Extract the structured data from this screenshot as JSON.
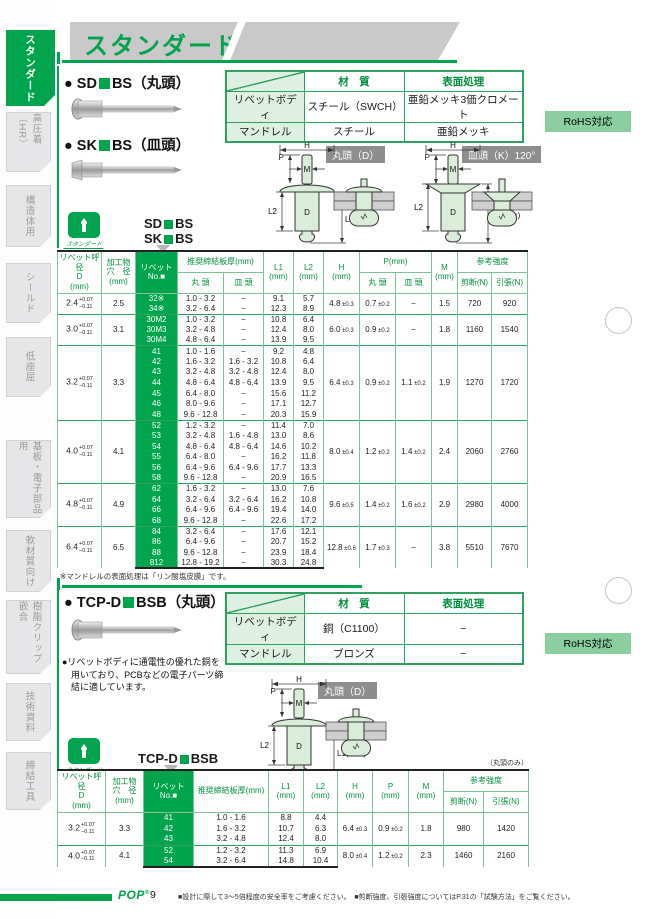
{
  "header": {
    "title": "スタンダード"
  },
  "sidebar": {
    "tabs": [
      {
        "label": "スタンダード",
        "active": true
      },
      {
        "label": "高圧着（HR）",
        "active": false
      },
      {
        "label": "構造体用",
        "active": false
      },
      {
        "label": "シールド",
        "active": false
      },
      {
        "label": "低座屈",
        "active": false
      },
      {
        "label": "基板・電子部品用",
        "active": false
      },
      {
        "label": "軟材質向け",
        "active": false
      },
      {
        "label": "樹脂クリップ嵌合",
        "active": false
      },
      {
        "label": "技術資料",
        "active": false
      },
      {
        "label": "締結工具",
        "active": false
      }
    ]
  },
  "dims": {
    "h": "H",
    "p": "P",
    "m": "M",
    "l2": "L2",
    "d": "D",
    "l1": "L1(max)"
  },
  "stamp_text": "スタンダード",
  "rohs": "RoHS対応",
  "section1": {
    "title1_pre": "● SD",
    "title1_post": "BS（丸頭）",
    "title2_pre": "● SK",
    "title2_post": "BS（皿頭）",
    "material": {
      "col_material": "材　質",
      "col_surface": "表面処理",
      "rows": [
        {
          "part": "リベットボディ",
          "material": "スチール（SWCH）",
          "surface": "亜鉛メッキ3価クロメート"
        },
        {
          "part": "マンドレル",
          "material": "スチール",
          "surface": "亜鉛メッキ"
        }
      ]
    },
    "label_round": "丸頭（D）",
    "label_flat": "皿頭（K）120°",
    "callout1_pre": "SD",
    "callout1_post": "BS",
    "callout2_pre": "SK",
    "callout2_post": "BS",
    "note": "※マンドレルの表面処理は「リン酸塩皮膜」です。"
  },
  "table1": {
    "head": {
      "dia": [
        "リベット呼径",
        "D",
        "(mm)"
      ],
      "hole": [
        "加工物",
        "穴　径",
        "(mm)"
      ],
      "rivet": [
        "リベット",
        "No.■"
      ],
      "plate": "推奨締結板厚(mm)",
      "round": "丸 頭",
      "flat": "皿 頭",
      "l1": [
        "L1",
        "(mm)"
      ],
      "l2": [
        "L2",
        "(mm)"
      ],
      "h": [
        "H",
        "(mm)"
      ],
      "p": "P(mm)",
      "p_round": "丸 頭",
      "p_flat": "皿 頭",
      "m": [
        "M",
        "(mm)"
      ],
      "strength": "参考強度",
      "shear": "剪断(N)",
      "tensile": "引張(N)"
    },
    "groups": [
      {
        "dia": "2.4",
        "tp": "+0.07",
        "tm": "−0.11",
        "hole": "2.5",
        "h": "4.8",
        "h_tol": "±0.3",
        "p_round": "0.7",
        "p_round_tol": "±0.2",
        "p_flat": "−",
        "p_flat_tol": "",
        "m": "1.5",
        "shear": "720",
        "tensile": "920",
        "rows": [
          [
            "32※",
            "1.0 - 3.2",
            "−",
            "9.1",
            "5.7"
          ],
          [
            "34※",
            "3.2 - 6.4",
            "−",
            "12.3",
            "8.9"
          ]
        ]
      },
      {
        "dia": "3.0",
        "tp": "+0.07",
        "tm": "−0.11",
        "hole": "3.1",
        "h": "6.0",
        "h_tol": "±0.3",
        "p_round": "0.9",
        "p_round_tol": "±0.2",
        "p_flat": "−",
        "p_flat_tol": "",
        "m": "1.8",
        "shear": "1160",
        "tensile": "1540",
        "rows": [
          [
            "30M2",
            "1.0 - 3.2",
            "−",
            "10.8",
            "6.4"
          ],
          [
            "30M3",
            "3.2 - 4.8",
            "−",
            "12.4",
            "8.0"
          ],
          [
            "30M4",
            "4.8 - 6.4",
            "−",
            "13.9",
            "9.5"
          ]
        ]
      },
      {
        "dia": "3.2",
        "tp": "+0.07",
        "tm": "−0.11",
        "hole": "3.3",
        "h": "6.4",
        "h_tol": "±0.3",
        "p_round": "0.9",
        "p_round_tol": "±0.2",
        "p_flat": "1.1",
        "p_flat_tol": "±0.2",
        "m": "1.9",
        "shear": "1270",
        "tensile": "1720",
        "rows": [
          [
            "41",
            "1.0 - 1.6",
            "−",
            "9.2",
            "4.8"
          ],
          [
            "42",
            "1.6 - 3.2",
            "1.6 - 3.2",
            "10.8",
            "6.4"
          ],
          [
            "43",
            "3.2 - 4.8",
            "3.2 - 4.8",
            "12.4",
            "8.0"
          ],
          [
            "44",
            "4.8 - 6.4",
            "4.8 - 6.4",
            "13.9",
            "9.5"
          ],
          [
            "45",
            "6.4 - 8.0",
            "−",
            "15.6",
            "11.2"
          ],
          [
            "46",
            "8.0 - 9.6",
            "−",
            "17.1",
            "12.7"
          ],
          [
            "48",
            "9.6 - 12.8",
            "−",
            "20.3",
            "15.9"
          ]
        ]
      },
      {
        "dia": "4.0",
        "tp": "+0.07",
        "tm": "−0.11",
        "hole": "4.1",
        "h": "8.0",
        "h_tol": "±0.4",
        "p_round": "1.2",
        "p_round_tol": "±0.2",
        "p_flat": "1.4",
        "p_flat_tol": "±0.2",
        "m": "2.4",
        "shear": "2060",
        "tensile": "2760",
        "rows": [
          [
            "52",
            "1.2 - 3.2",
            "−",
            "11.4",
            "7.0"
          ],
          [
            "53",
            "3.2 - 4.8",
            "1.6 - 4.8",
            "13.0",
            "8.6"
          ],
          [
            "54",
            "4.8 - 6.4",
            "4.8 - 6.4",
            "14.6",
            "10.2"
          ],
          [
            "55",
            "6.4 - 8.0",
            "−",
            "16.2",
            "11.8"
          ],
          [
            "56",
            "6.4 - 9.6",
            "6.4 - 9.6",
            "17.7",
            "13.3"
          ],
          [
            "58",
            "9.6 - 12.8",
            "−",
            "20.9",
            "16.5"
          ]
        ]
      },
      {
        "dia": "4.8",
        "tp": "+0.07",
        "tm": "−0.11",
        "hole": "4.9",
        "h": "9.6",
        "h_tol": "±0.5",
        "p_round": "1.4",
        "p_round_tol": "±0.2",
        "p_flat": "1.6",
        "p_flat_tol": "±0.2",
        "m": "2.9",
        "shear": "2980",
        "tensile": "4000",
        "rows": [
          [
            "62",
            "1.6 - 3.2",
            "−",
            "13.0",
            "7.6"
          ],
          [
            "64",
            "3.2 - 6.4",
            "3.2 - 6.4",
            "16.2",
            "10.8"
          ],
          [
            "66",
            "6.4 - 9.6",
            "6.4 - 9.6",
            "19.4",
            "14.0"
          ],
          [
            "68",
            "9.6 - 12.8",
            "−",
            "22.6",
            "17.2"
          ]
        ]
      },
      {
        "dia": "6.4",
        "tp": "+0.07",
        "tm": "−0.11",
        "hole": "6.5",
        "h": "12.8",
        "h_tol": "±0.6",
        "p_round": "1.7",
        "p_round_tol": "±0.3",
        "p_flat": "−",
        "p_flat_tol": "",
        "m": "3.8",
        "shear": "5510",
        "tensile": "7670",
        "rows": [
          [
            "84",
            "3.2 - 6.4",
            "−",
            "17.6",
            "12.1"
          ],
          [
            "86",
            "6.4 - 9.6",
            "−",
            "20.7",
            "15.2"
          ],
          [
            "88",
            "9.6 - 12.8",
            "−",
            "23.9",
            "18.4"
          ],
          [
            "812",
            "12.8 - 19.2",
            "−",
            "30.3",
            "24.8"
          ]
        ]
      }
    ]
  },
  "section2": {
    "title_pre": "● TCP-D",
    "title_post": "BSB（丸頭）",
    "material": {
      "col_material": "材　質",
      "col_surface": "表面処理",
      "rows": [
        {
          "part": "リベットボディ",
          "material": "銅（C1100）",
          "surface": "−"
        },
        {
          "part": "マンドレル",
          "material": "ブロンズ",
          "surface": "−"
        }
      ]
    },
    "desc": [
      "●リベットボディに通電性の優れた銅を",
      "　用いており、PCBなどの電子パーツ締",
      "　結に適しています。"
    ],
    "label_round": "丸頭（D）",
    "callout_pre": "TCP-D",
    "callout_post": "BSB",
    "round_only": "（丸頭のみ）"
  },
  "table2": {
    "head": {
      "dia": [
        "リベット呼径",
        "D",
        "(mm)"
      ],
      "hole": [
        "加工物",
        "穴　径",
        "(mm)"
      ],
      "rivet": [
        "リベット",
        "No.■"
      ],
      "plate": "推奨締結板厚(mm)",
      "l1": [
        "L1",
        "(mm)"
      ],
      "l2": [
        "L2",
        "(mm)"
      ],
      "h": [
        "H",
        "(mm)"
      ],
      "p": [
        "P",
        "(mm)"
      ],
      "m": [
        "M",
        "(mm)"
      ],
      "strength": "参考強度",
      "shear": "剪断(N)",
      "tensile": "引張(N)"
    },
    "groups": [
      {
        "dia": "3.2",
        "tp": "+0.07",
        "tm": "−0.11",
        "hole": "3.3",
        "h": "6.4",
        "h_tol": "±0.3",
        "p": "0.9",
        "p_tol": "±0.2",
        "m": "1.8",
        "shear": "980",
        "tensile": "1420",
        "rows": [
          [
            "41",
            "1.0 - 1.6",
            "8.8",
            "4.4"
          ],
          [
            "42",
            "1.6 - 3.2",
            "10.7",
            "6.3"
          ],
          [
            "43",
            "3.2 - 4.8",
            "12.4",
            "8.0"
          ]
        ]
      },
      {
        "dia": "4.0",
        "tp": "+0.07",
        "tm": "−0.11",
        "hole": "4.1",
        "h": "8.0",
        "h_tol": "±0.4",
        "p": "1.2",
        "p_tol": "±0.2",
        "m": "2.3",
        "shear": "1460",
        "tensile": "2160",
        "rows": [
          [
            "52",
            "1.2 - 3.2",
            "11.3",
            "6.9"
          ],
          [
            "54",
            "3.2 - 6.4",
            "14.8",
            "10.4"
          ]
        ]
      }
    ]
  },
  "footer": {
    "logo": "POP",
    "reg": "®",
    "page": "9",
    "note1": "■設計に際して3～5倍程度の安全率をご考慮ください。",
    "note2": "■剪断強度、引張強度についてはP.31の「試験方法」をご覧ください。"
  }
}
